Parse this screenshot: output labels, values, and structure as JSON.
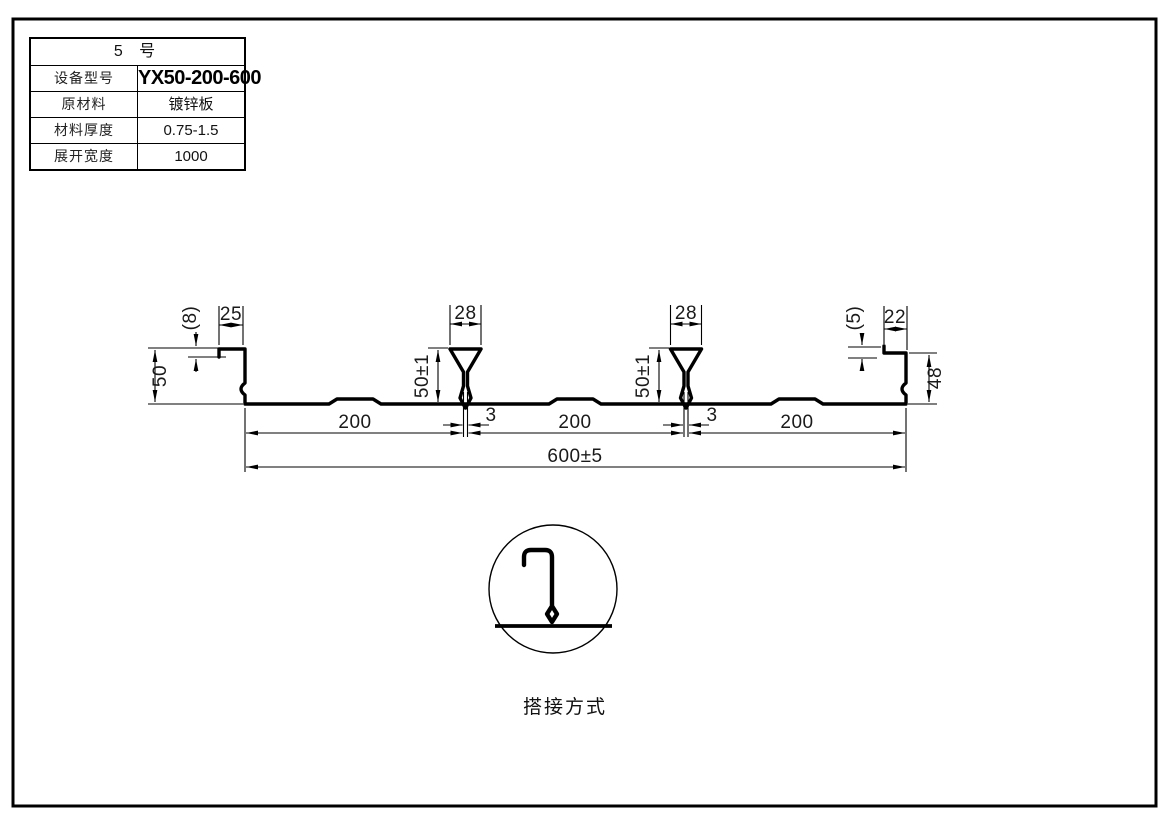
{
  "title_block": {
    "header": "5 号",
    "rows": [
      {
        "label": "设备型号",
        "value": "YX50-200-600"
      },
      {
        "label": "原材料",
        "value": "镀锌板"
      },
      {
        "label": "材料厚度",
        "value": "0.75-1.5"
      },
      {
        "label": "展开宽度",
        "value": "1000"
      }
    ]
  },
  "profile_dimensions": {
    "left_lip_width": "25",
    "left_hook_drop": "(8)",
    "left_rib_height": "50",
    "dovetail_top_width": "28",
    "dovetail_height": "50±1",
    "dovetail_slot": "3",
    "right_hook_rise": "(5)",
    "right_lip_width": "22",
    "right_rib_height": "48",
    "pitch": "200",
    "overall_width": "600±5"
  },
  "detail": {
    "caption": "搭接方式"
  },
  "colors": {
    "line": "#000000",
    "background": "#ffffff"
  }
}
